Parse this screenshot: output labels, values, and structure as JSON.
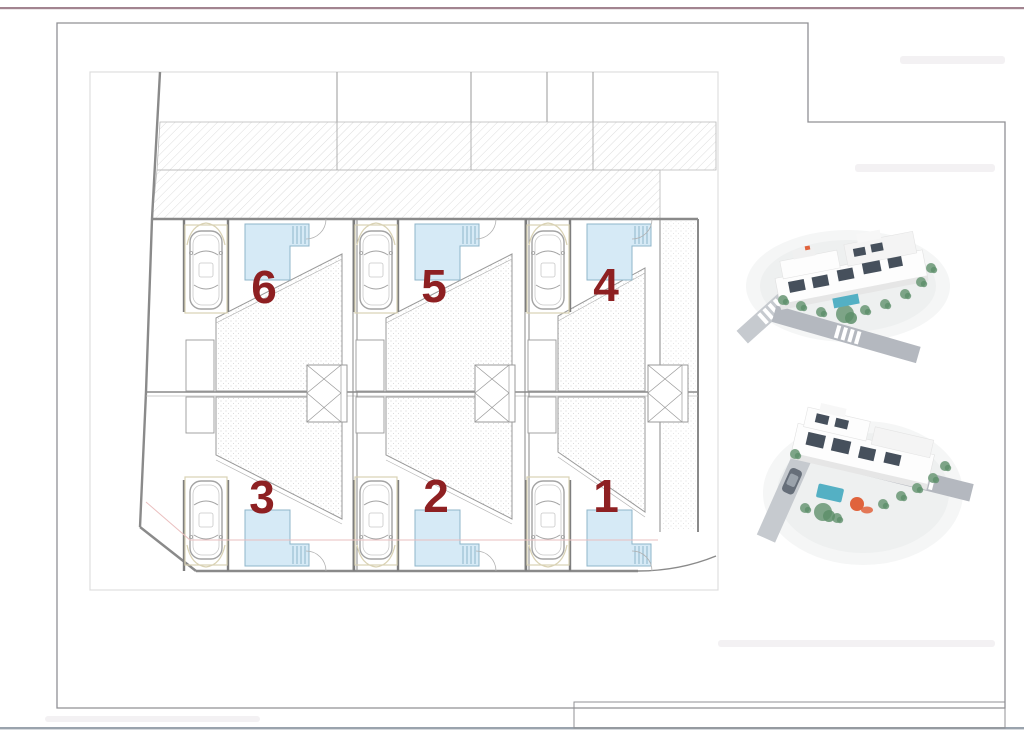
{
  "page": {
    "background": "#ffffff",
    "top_border_color": "#a28490",
    "bottom_border_color": "#9aa3ad",
    "sheet_frame_color": "#909094",
    "inner_frame_color": "#dedede",
    "watermark_color": "#f3f1f3"
  },
  "plan": {
    "accent_color": "#8e2022",
    "pool_fill": "#d6eaf6",
    "pool_border": "#8fb5c9",
    "wall_color": "#8a8a8a",
    "thin_line_color": "#b0b0b0",
    "hatch_color": "#cfcfcf",
    "stipple_color": "#c8c8c8",
    "carport_color": "#d9d2b4",
    "section_line_color": "#eabfbf",
    "units": [
      {
        "number": "6"
      },
      {
        "number": "5"
      },
      {
        "number": "4"
      },
      {
        "number": "3"
      },
      {
        "number": "2"
      },
      {
        "number": "1"
      }
    ]
  },
  "renders": {
    "building_white": "#fdfdfd",
    "building_shade": "#e6e6e6",
    "window_dark": "#46505c",
    "greenery": "#7da487",
    "greenery_dark": "#5d8f6a",
    "road_gray": "#c6cacf",
    "road_dark": "#b4b8bf",
    "pool_teal": "#54b0c4",
    "accent_orange": "#e0633c",
    "car_dark": "#666e79"
  }
}
